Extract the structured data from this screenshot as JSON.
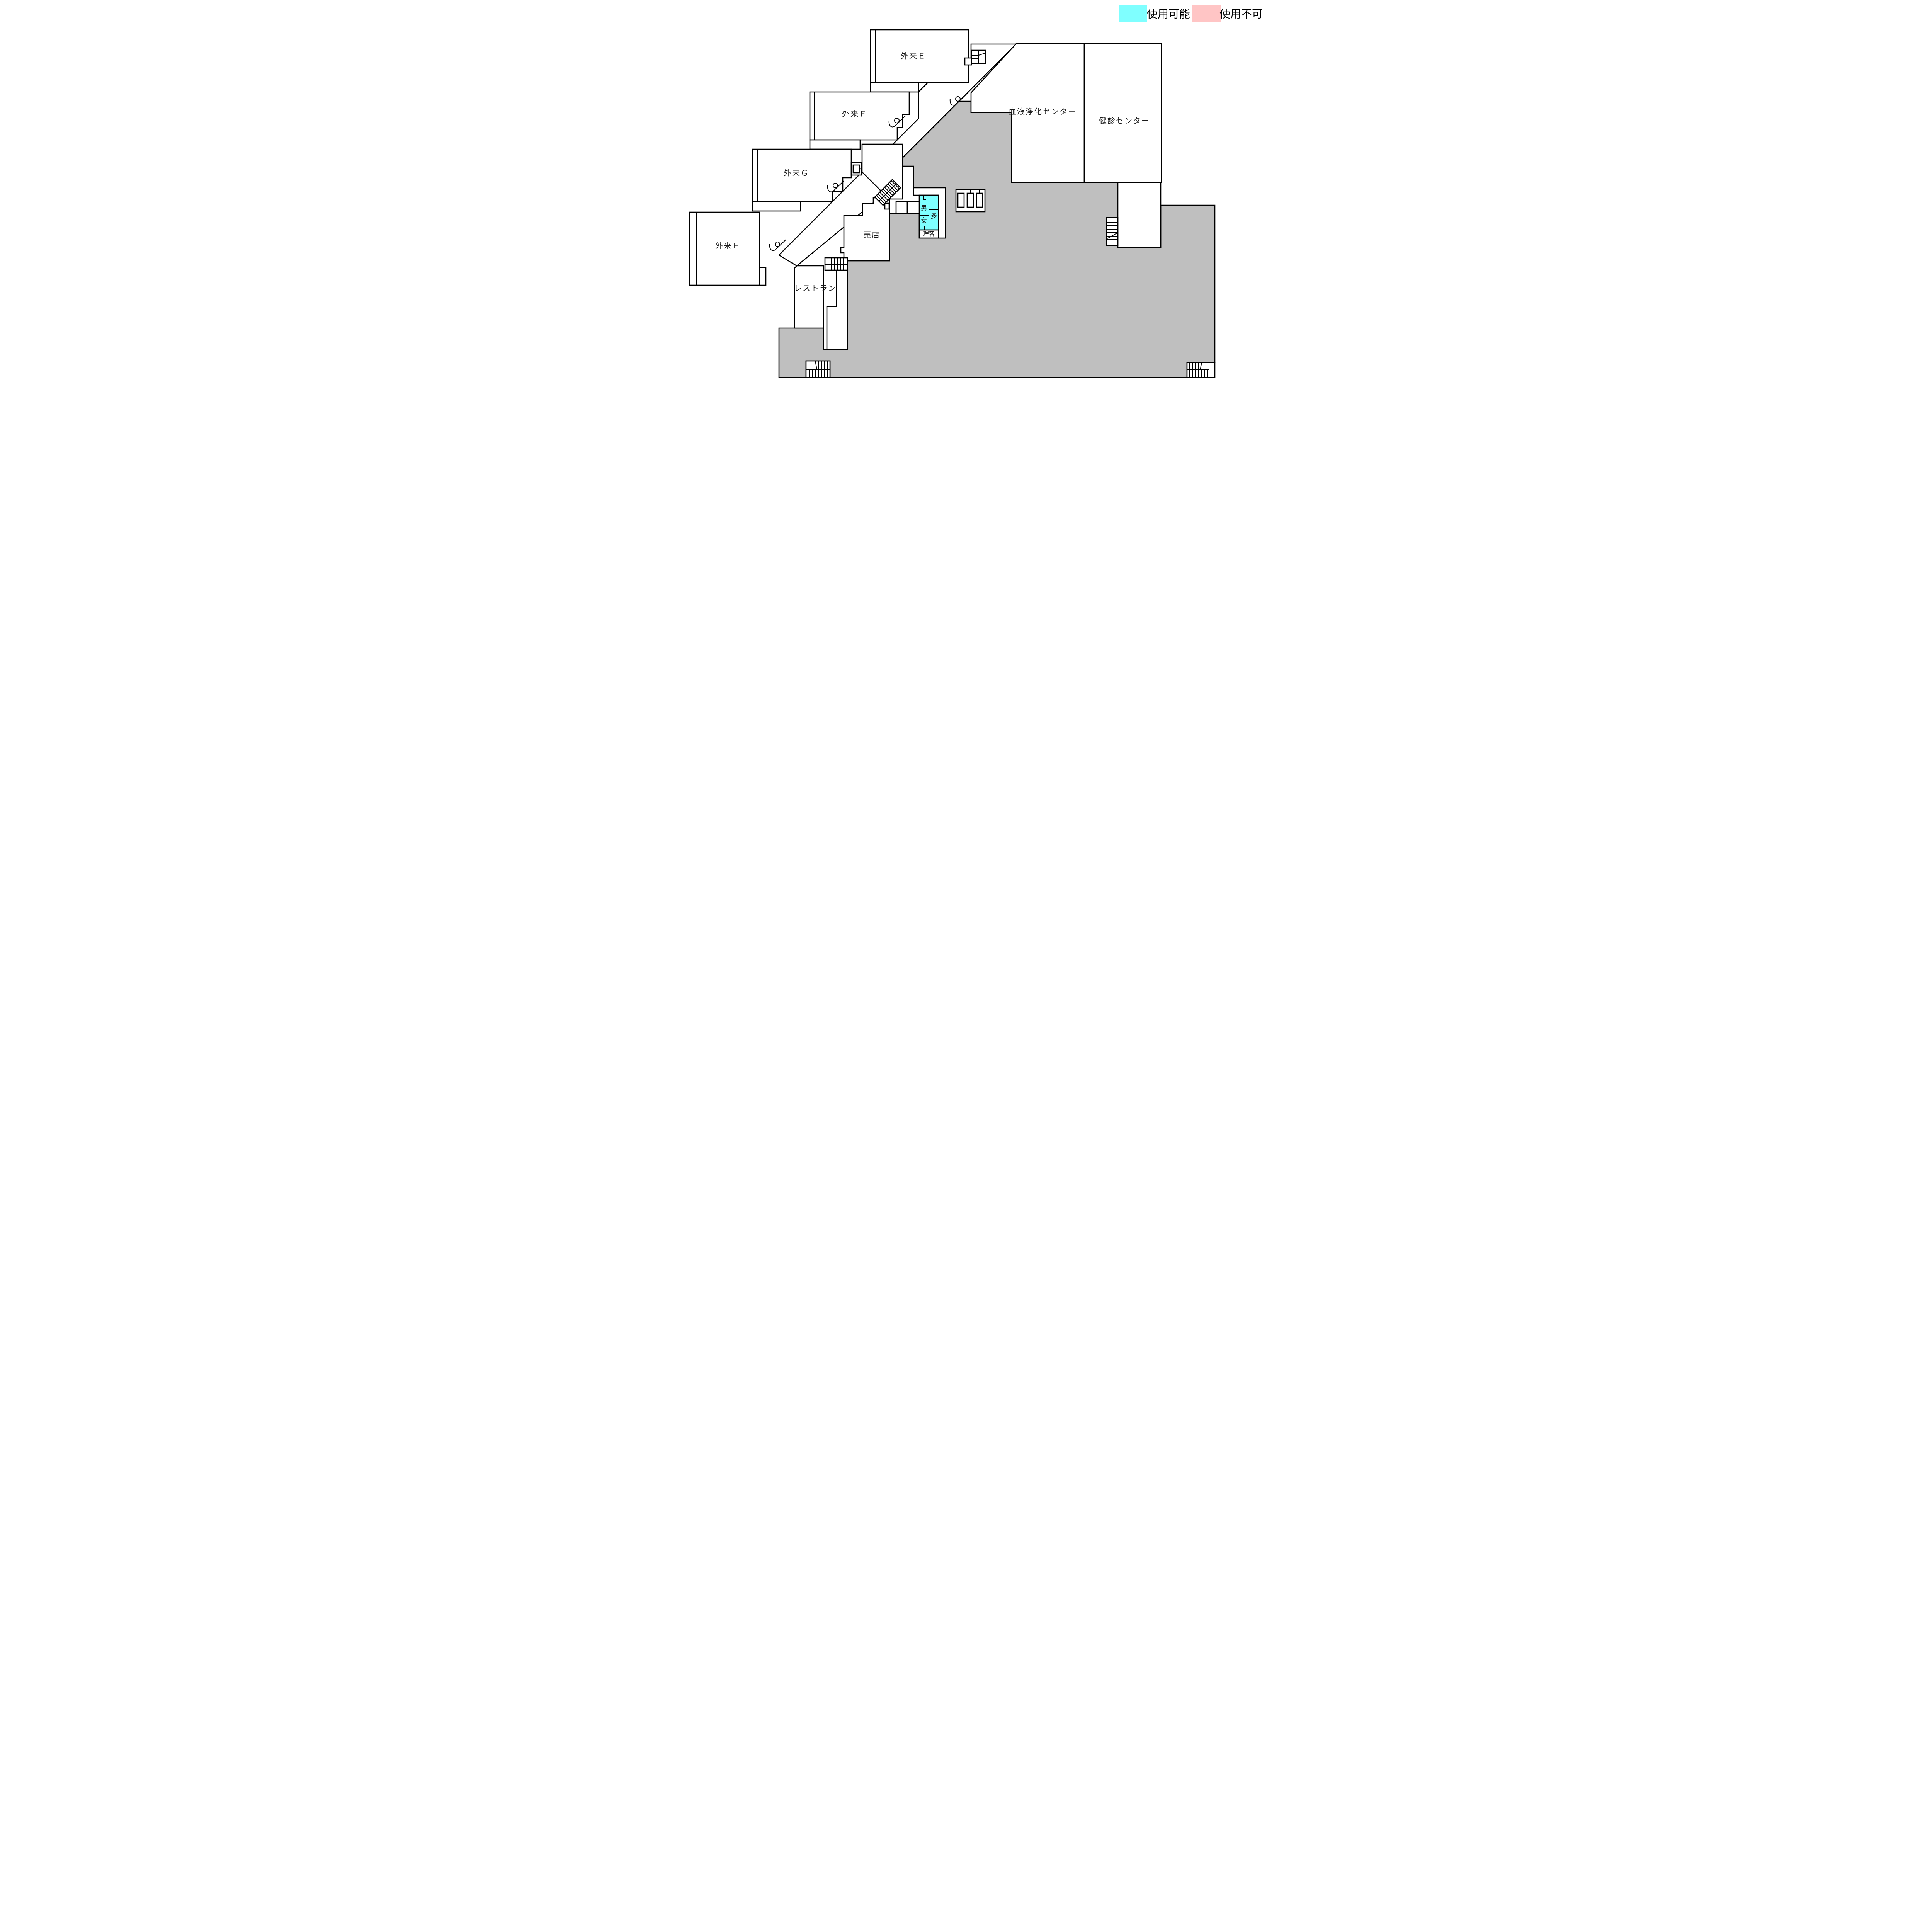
{
  "legend": {
    "available_label": "使用可能",
    "unavailable_label": "使用不可"
  },
  "colors": {
    "available": "#7fffff",
    "unavailable": "#ffc5c5",
    "closed_area": "#bfbfbf",
    "wall": "#000000",
    "room_fill": "#ffffff"
  },
  "rooms": {
    "outpatient_e": "外来Ｅ",
    "outpatient_f": "外来Ｆ",
    "outpatient_g": "外来Ｇ",
    "outpatient_h": "外来Ｈ",
    "blood_purification_center": "血液浄化センター",
    "checkup_center": "健診センター",
    "shop": "売店",
    "restaurant": "レストラン",
    "barber": "理容",
    "toilet_male": "男",
    "toilet_female": "女",
    "toilet_multi": "多"
  }
}
